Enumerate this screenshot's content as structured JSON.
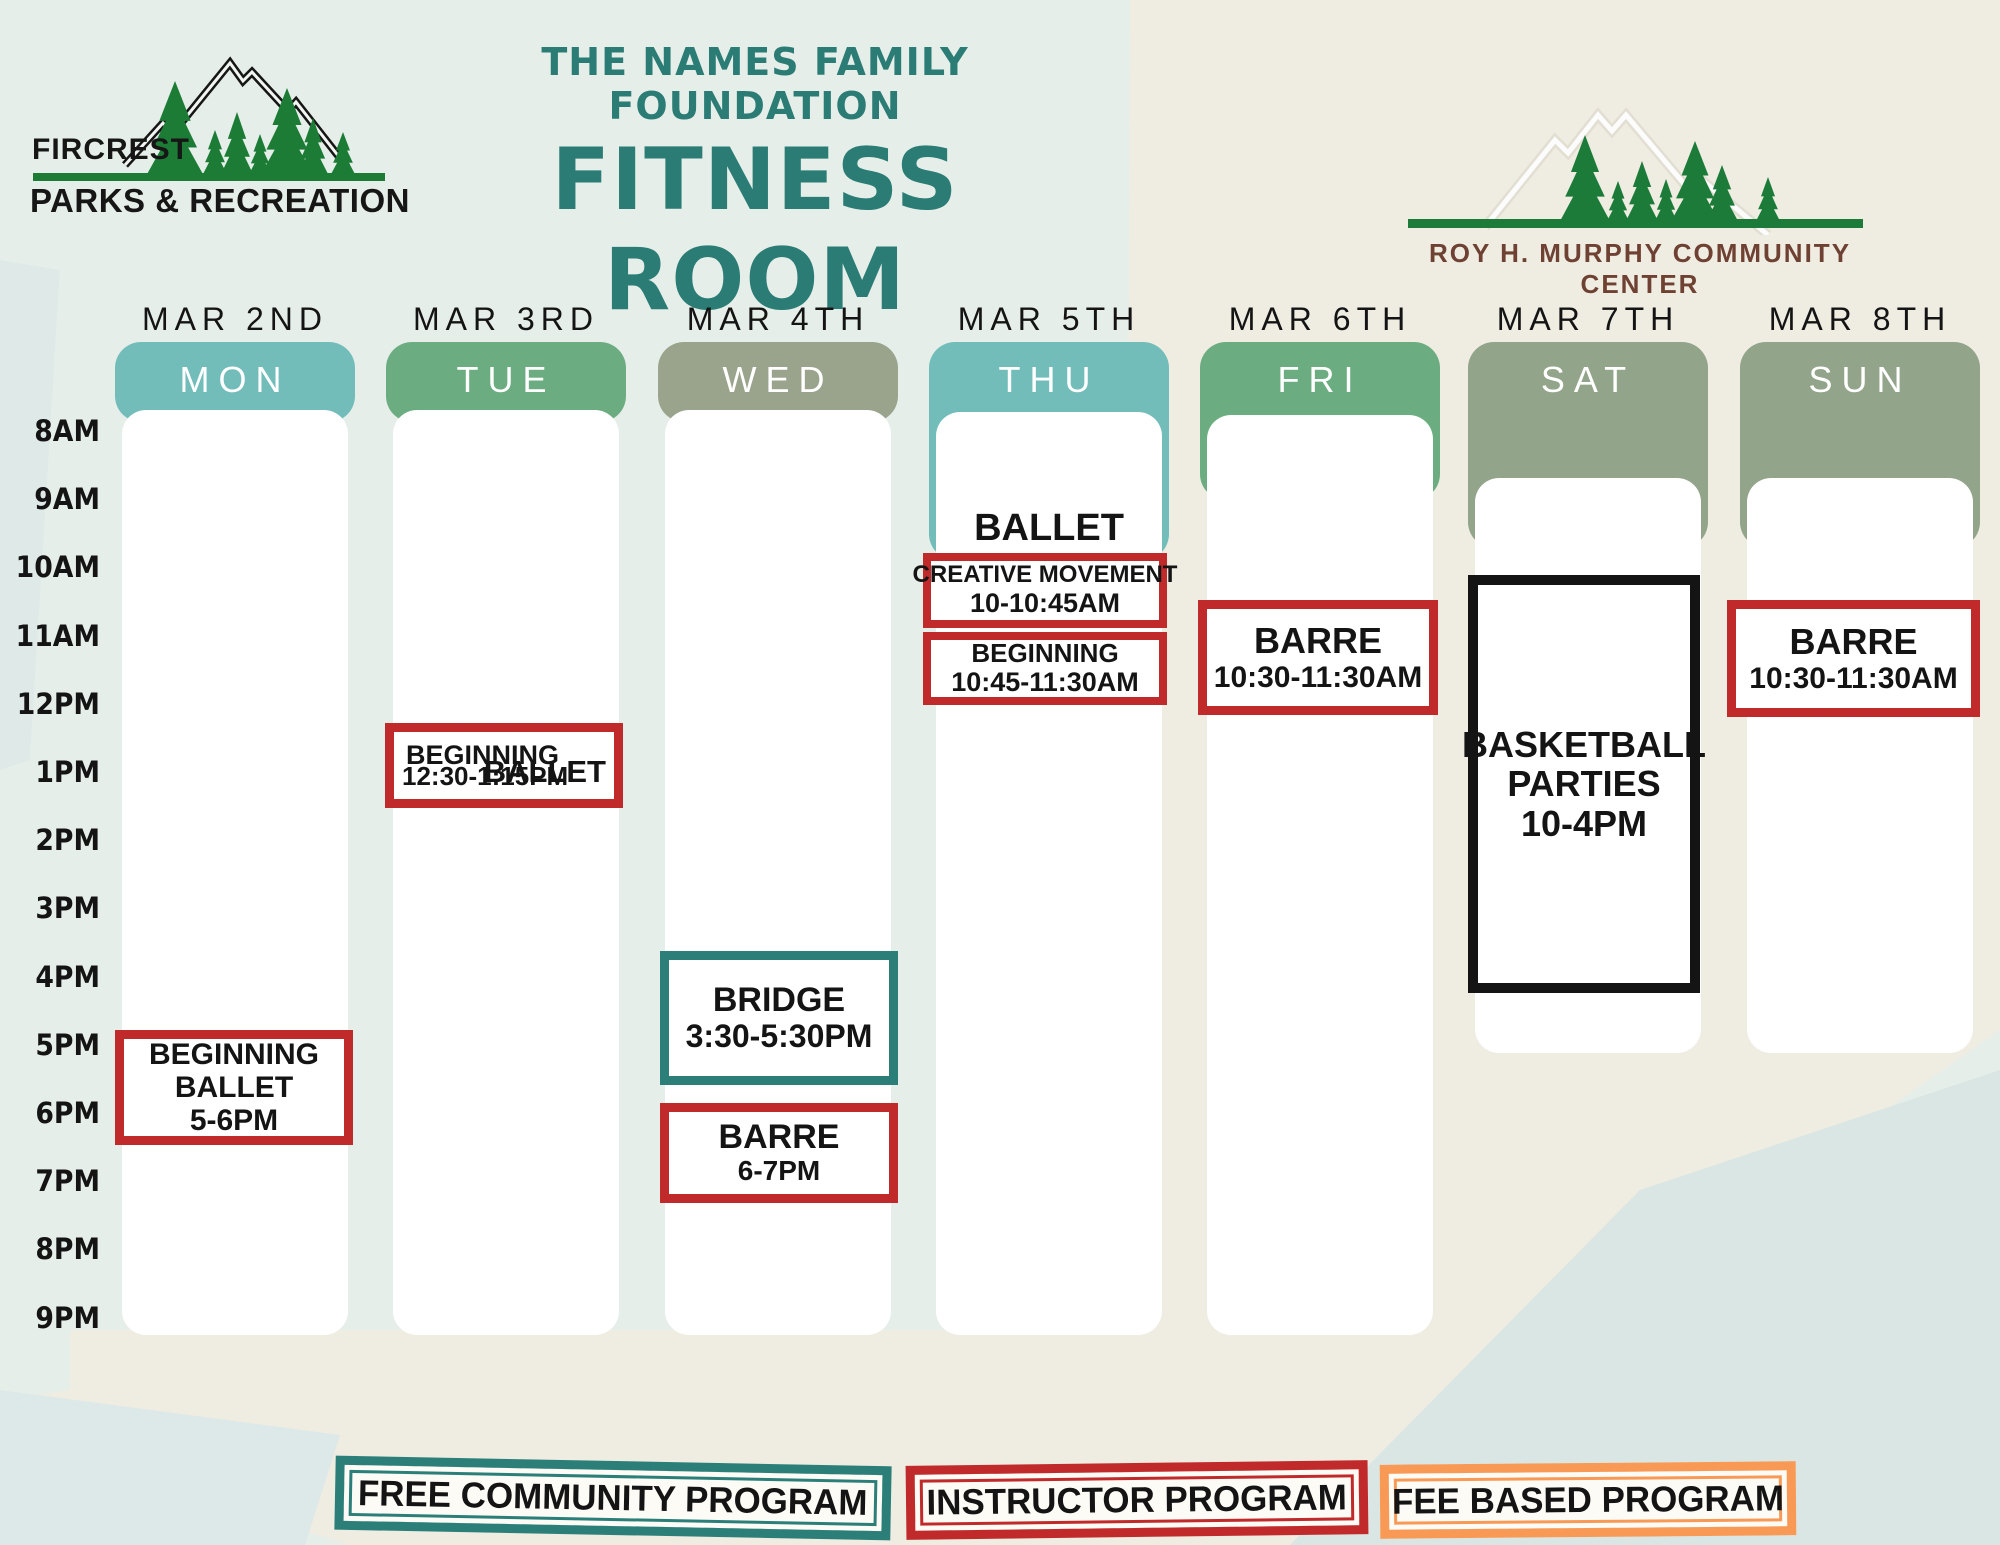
{
  "branding": {
    "left_logo": {
      "top": "FIRCREST",
      "bottom": "PARKS & RECREATION",
      "tree_color": "#1c7c35"
    },
    "title": {
      "line1": "THE NAMES FAMILY FOUNDATION",
      "line2": "FITNESS ROOM",
      "color": "#2b7c75"
    },
    "right_logo": {
      "caption": "ROY H. MURPHY COMMUNITY CENTER",
      "caption_color": "#6e4133",
      "tree_color": "#1d7b3a"
    }
  },
  "calendar": {
    "times": [
      "8AM",
      "9AM",
      "10AM",
      "11AM",
      "12PM",
      "1PM",
      "2PM",
      "3PM",
      "4PM",
      "5PM",
      "6PM",
      "7PM",
      "8PM",
      "9PM"
    ],
    "days": [
      {
        "date": "MAR 2ND",
        "day": "MON",
        "header_color": "#72bdb9",
        "events": [
          {
            "kind": "box",
            "lines": [
              "BEGINNING",
              "BALLET"
            ],
            "time": "5-6PM",
            "program": "instructor"
          }
        ]
      },
      {
        "date": "MAR 3RD",
        "day": "TUE",
        "header_color": "#6bad80",
        "events": [
          {
            "kind": "box-side",
            "lines": [
              "BEGINNING"
            ],
            "side": "BALLET",
            "time": "12:30-1:15PM",
            "program": "instructor"
          }
        ]
      },
      {
        "date": "MAR 4TH",
        "day": "WED",
        "header_color": "#9aa38c",
        "events": [
          {
            "kind": "box",
            "lines": [
              "BRIDGE"
            ],
            "time": "3:30-5:30PM",
            "program": "free"
          },
          {
            "kind": "box",
            "lines": [
              "BARRE"
            ],
            "time": "6-7PM",
            "program": "instructor"
          }
        ]
      },
      {
        "date": "MAR 5TH",
        "day": "THU",
        "header_color": "#72bdb9",
        "events": [
          {
            "kind": "heading",
            "text": "BALLET"
          },
          {
            "kind": "box",
            "lines": [
              "CREATIVE MOVEMENT"
            ],
            "time": "10-10:45AM",
            "program": "instructor"
          },
          {
            "kind": "box",
            "lines": [
              "BEGINNING"
            ],
            "time": "10:45-11:30AM",
            "program": "instructor"
          }
        ]
      },
      {
        "date": "MAR 6TH",
        "day": "FRI",
        "header_color": "#6bad80",
        "events": [
          {
            "kind": "box",
            "lines": [
              "BARRE"
            ],
            "time": "10:30-11:30AM",
            "program": "instructor"
          }
        ]
      },
      {
        "date": "MAR 7TH",
        "day": "SAT",
        "header_color": "#92a489",
        "events": [
          {
            "kind": "box",
            "lines": [
              "BASKETBALL",
              "PARTIES"
            ],
            "time": "10-4PM",
            "program": "neutral"
          }
        ]
      },
      {
        "date": "MAR 8TH",
        "day": "SUN",
        "header_color": "#92a489",
        "events": [
          {
            "kind": "box",
            "lines": [
              "BARRE"
            ],
            "time": "10:30-11:30AM",
            "program": "instructor"
          }
        ]
      }
    ]
  },
  "legend": [
    {
      "label": "FREE COMMUNITY PROGRAM",
      "program": "free"
    },
    {
      "label": "INSTRUCTOR PROGRAM",
      "program": "instructor"
    },
    {
      "label": "FEE BASED PROGRAM",
      "program": "fee"
    }
  ],
  "program_colors": {
    "free": "#2b7f78",
    "instructor": "#c02a2b",
    "fee": "#f89a55",
    "neutral": "#141414"
  },
  "background_colors": {
    "mint": "#e6eeea",
    "beige": "#efece2",
    "pale_blue": "#dde9e8",
    "pale_blue2": "#d9e6e3"
  }
}
